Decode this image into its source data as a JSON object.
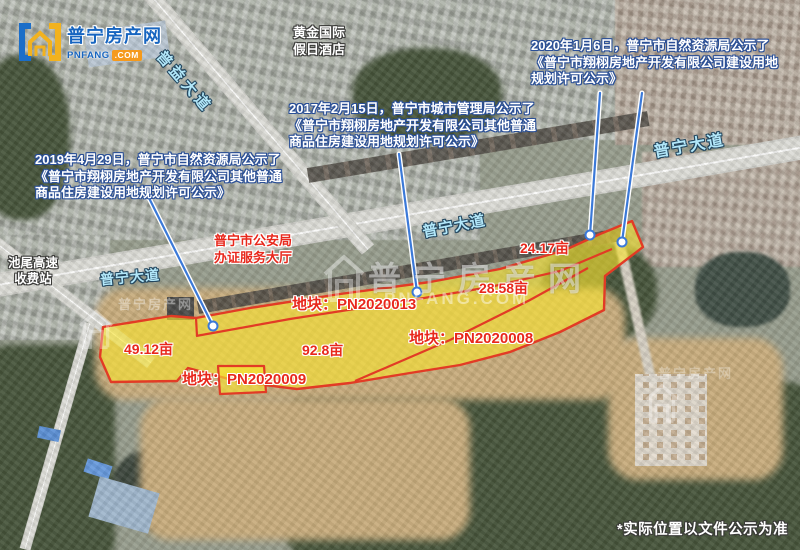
{
  "logo": {
    "title": "普宁房产网",
    "domain": "PNFANG",
    "suffix": ".COM"
  },
  "watermark": {
    "title": "普宁房产网",
    "site": "PNFANG.COM"
  },
  "notices": {
    "n2019": {
      "l1": "2019年4月29日，普宁市自然资源局公示了",
      "l2": "《普宁市翔栩房地产开发有限公司其他普通",
      "l3": "商品住房建设用地规划许可公示》"
    },
    "n2017": {
      "l1": "2017年2月15日，普宁市城市管理局公示了",
      "l2": "《普宁市翔栩房地产开发有限公司其他普通",
      "l3": "商品住房建设用地规划许可公示》"
    },
    "n2020": {
      "l1": "2020年1月6日，普宁市自然资源局公示了",
      "l2": "《普宁市翔栩房地产开发有限公司建设用地",
      "l3": "规划许可公示》"
    }
  },
  "pois": {
    "hotel_l1": "黄金国际",
    "hotel_l2": "假日酒店",
    "police_l1": "普宁市公安局",
    "police_l2": "办证服务大厅",
    "toll_l1": "池尾高速",
    "toll_l2": "收费站"
  },
  "roads": {
    "puyi": "普益大道",
    "puning": "普宁大道"
  },
  "plots": {
    "area_49": "49.12亩",
    "area_92": "92.8亩",
    "area_24": "24.17亩",
    "area_28": "28.58亩",
    "code_13": "地块：PN2020013",
    "code_09": "地块：PN2020009",
    "code_08": "地块：PN2020008"
  },
  "disclaimer": "*实际位置以文件公示为准",
  "colors": {
    "plot_fill": "#f8e330",
    "plot_border": "#e23b25",
    "label_red": "#e8281c",
    "road_cyan": "#b2e7f9",
    "leader_blue": "#3b79d8",
    "logo_blue": "#1765c0",
    "logo_orange": "#f59a1d"
  }
}
